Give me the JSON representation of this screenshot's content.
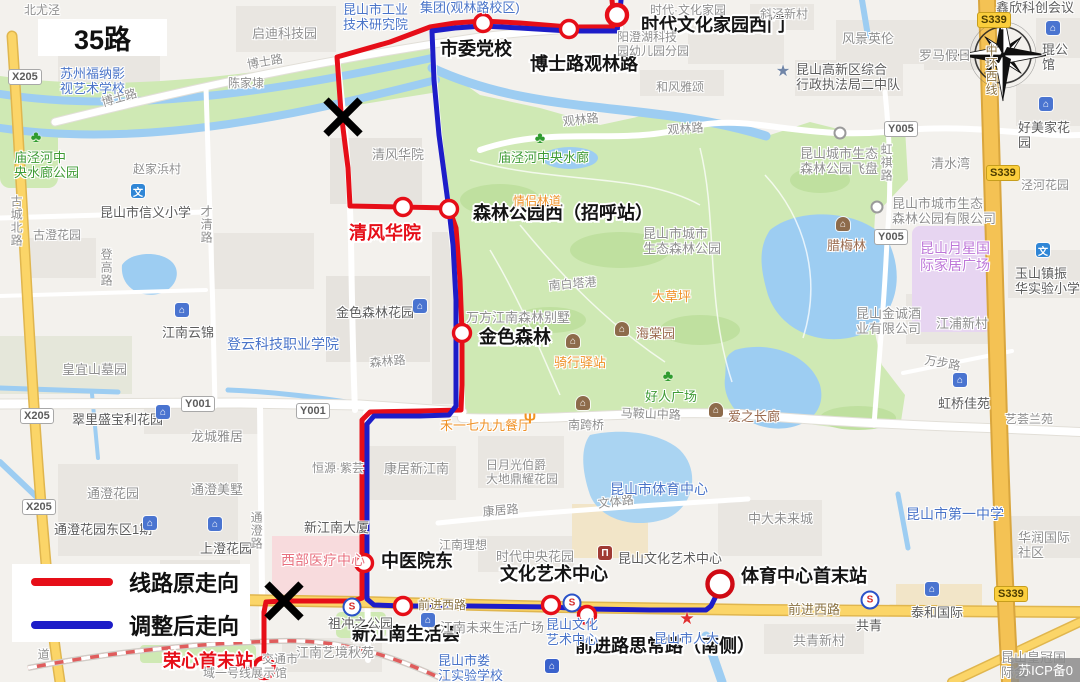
{
  "title": "35路",
  "legend": {
    "original_label": "线路原走向",
    "adjusted_label": "调整后走向",
    "original_color": "#e60e18",
    "adjusted_color": "#1d1dc8"
  },
  "watermark": "苏ICP备0",
  "routes": {
    "original": {
      "name": "线路原走向",
      "color": "#e60e18",
      "points": [
        [
          612,
          0
        ],
        [
          613,
          10
        ],
        [
          615,
          20
        ],
        [
          614,
          27
        ],
        [
          569,
          27
        ],
        [
          520,
          23
        ],
        [
          483,
          21
        ],
        [
          455,
          23
        ],
        [
          430,
          27
        ],
        [
          390,
          42
        ],
        [
          337,
          57
        ],
        [
          341,
          112
        ],
        [
          348,
          168
        ],
        [
          350,
          206
        ],
        [
          403,
          207
        ],
        [
          449,
          208
        ],
        [
          456,
          228
        ],
        [
          460,
          280
        ],
        [
          462,
          333
        ],
        [
          462,
          385
        ],
        [
          461,
          410
        ],
        [
          420,
          411
        ],
        [
          370,
          412
        ],
        [
          362,
          420
        ],
        [
          362,
          480
        ],
        [
          362,
          563
        ],
        [
          362,
          598
        ],
        [
          354,
          601
        ],
        [
          283,
          601
        ],
        [
          266,
          602
        ],
        [
          264,
          612
        ],
        [
          264,
          668
        ]
      ]
    },
    "adjusted": {
      "name": "调整后走向",
      "color": "#1d1dc8",
      "points": [
        [
          621,
          0
        ],
        [
          620,
          12
        ],
        [
          618,
          24
        ],
        [
          617,
          31
        ],
        [
          569,
          31
        ],
        [
          520,
          28
        ],
        [
          483,
          26
        ],
        [
          455,
          28
        ],
        [
          432,
          31
        ],
        [
          434,
          80
        ],
        [
          439,
          135
        ],
        [
          445,
          180
        ],
        [
          449,
          210
        ],
        [
          453,
          245
        ],
        [
          456,
          300
        ],
        [
          456,
          360
        ],
        [
          456,
          406
        ],
        [
          449,
          415
        ],
        [
          420,
          416
        ],
        [
          374,
          416
        ],
        [
          367,
          424
        ],
        [
          367,
          480
        ],
        [
          367,
          563
        ],
        [
          367,
          599
        ],
        [
          374,
          605
        ],
        [
          403,
          606
        ],
        [
          470,
          606
        ],
        [
          551,
          607
        ],
        [
          587,
          609
        ],
        [
          650,
          610
        ],
        [
          706,
          610
        ],
        [
          711,
          606
        ],
        [
          716,
          596
        ],
        [
          720,
          588
        ]
      ]
    }
  },
  "stations": [
    {
      "name": "市委党校",
      "x": 483,
      "y": 23,
      "lx": 440,
      "ly": 40,
      "color": "black"
    },
    {
      "name": "博士路观林路",
      "x": 569,
      "y": 29,
      "lx": 530,
      "ly": 55,
      "color": "black"
    },
    {
      "name": "时代文化家园西门",
      "x": 617,
      "y": 15,
      "lx": 641,
      "ly": 16,
      "color": "black",
      "big": true
    },
    {
      "name": "森林公园西（招呼站）",
      "x": 449,
      "y": 209,
      "lx": 473,
      "ly": 204,
      "color": "black"
    },
    {
      "name": "清风华院",
      "x": 403,
      "y": 207,
      "lx": 349,
      "ly": 224,
      "color": "red"
    },
    {
      "name": "金色森林",
      "x": 462,
      "y": 333,
      "lx": 479,
      "ly": 328,
      "color": "black"
    },
    {
      "name": "中医院东",
      "x": 364,
      "y": 563,
      "lx": 381,
      "ly": 552,
      "color": "black"
    },
    {
      "name": "新江南生活荟",
      "x": 403,
      "y": 606,
      "lx": 352,
      "ly": 625,
      "color": "black"
    },
    {
      "name": "文化艺术中心",
      "x": 551,
      "y": 605,
      "lx": 500,
      "ly": 565,
      "color": "black"
    },
    {
      "name": "前进路思常路（南侧）",
      "x": 587,
      "y": 615,
      "lx": 575,
      "ly": 637,
      "color": "black"
    },
    {
      "name": "体育中心首末站",
      "x": 720,
      "y": 584,
      "lx": 741,
      "ly": 567,
      "color": "black",
      "big": true,
      "r": 12.5,
      "ring": "#cf0a14"
    },
    {
      "name": "荣心首末站",
      "x": 264,
      "y": 668,
      "lx": 163,
      "ly": 652,
      "color": "red",
      "big": true
    }
  ],
  "x_marks": [
    [
      343,
      117
    ],
    [
      284,
      601
    ]
  ],
  "road_badges": [
    {
      "t": "X205",
      "x": 8,
      "y": 69
    },
    {
      "t": "X205",
      "x": 20,
      "y": 408
    },
    {
      "t": "X205",
      "x": 22,
      "y": 499
    },
    {
      "t": "Y001",
      "x": 181,
      "y": 396
    },
    {
      "t": "Y001",
      "x": 296,
      "y": 403
    },
    {
      "t": "Y005",
      "x": 884,
      "y": 121
    },
    {
      "t": "Y005",
      "x": 874,
      "y": 229
    },
    {
      "t": "S339",
      "x": 977,
      "y": 12,
      "prov": true
    },
    {
      "t": "S339",
      "x": 986,
      "y": 165,
      "prov": true
    },
    {
      "t": "S339",
      "x": 994,
      "y": 586,
      "prov": true
    }
  ],
  "map_labels": [
    {
      "t": "北尤泾",
      "x": 24,
      "y": 3,
      "c": "gray",
      "s": 12
    },
    {
      "t": "启迪科技园",
      "x": 252,
      "y": 26,
      "c": "gray",
      "s": 13
    },
    {
      "t": "苏州福纳影\n视艺术学校",
      "x": 60,
      "y": 66,
      "c": "blue",
      "s": 13
    },
    {
      "t": "博士路",
      "x": 100,
      "y": 96,
      "c": "gray",
      "s": 12,
      "r": -16
    },
    {
      "t": "博士路",
      "x": 246,
      "y": 58,
      "c": "gray",
      "s": 12,
      "r": -10
    },
    {
      "t": "陈家埭",
      "x": 228,
      "y": 76,
      "c": "gray",
      "s": 12
    },
    {
      "t": "庙泾河中\n央水廊公园",
      "x": 14,
      "y": 150,
      "c": "green",
      "s": 13
    },
    {
      "t": "赵家浜村",
      "x": 133,
      "y": 162,
      "c": "gray",
      "s": 12
    },
    {
      "t": "昆山市信义小学",
      "x": 100,
      "y": 205,
      "c": "dark",
      "s": 13
    },
    {
      "t": "古城北路",
      "x": 9,
      "y": 195,
      "c": "gray",
      "s": 12,
      "v": 1
    },
    {
      "t": "才清路",
      "x": 199,
      "y": 205,
      "c": "gray",
      "s": 12,
      "v": 1
    },
    {
      "t": "古澄花园",
      "x": 33,
      "y": 228,
      "c": "gray",
      "s": 12
    },
    {
      "t": "登高路",
      "x": 99,
      "y": 248,
      "c": "gray",
      "s": 12,
      "v": 1
    },
    {
      "t": "庙泾河中央水廊",
      "x": 498,
      "y": 150,
      "c": "green",
      "s": 13
    },
    {
      "t": "清风华院",
      "x": 372,
      "y": 147,
      "c": "gray",
      "s": 13
    },
    {
      "t": "昆山市工业\n技术研究院",
      "x": 343,
      "y": 2,
      "c": "blue",
      "s": 13
    },
    {
      "t": "集团(观林路校区)",
      "x": 420,
      "y": 0,
      "c": "blue",
      "s": 13
    },
    {
      "t": "时代·文化家园",
      "x": 650,
      "y": 3,
      "c": "gray",
      "s": 12
    },
    {
      "t": "阳澄湖科技\n园幼儿园分园",
      "x": 617,
      "y": 30,
      "c": "gray",
      "s": 12
    },
    {
      "t": "和风雅颂",
      "x": 656,
      "y": 80,
      "c": "gray",
      "s": 12
    },
    {
      "t": "观林路",
      "x": 562,
      "y": 115,
      "c": "gray",
      "s": 12,
      "r": -7
    },
    {
      "t": "观林路",
      "x": 667,
      "y": 123,
      "c": "gray",
      "s": 12,
      "r": -4
    },
    {
      "t": "斜泾新村",
      "x": 760,
      "y": 7,
      "c": "gray",
      "s": 12
    },
    {
      "t": "风景英伦",
      "x": 842,
      "y": 31,
      "c": "gray",
      "s": 13
    },
    {
      "t": "罗马假日",
      "x": 919,
      "y": 48,
      "c": "gray",
      "s": 13
    },
    {
      "t": "鑫欣科创会议中",
      "x": 996,
      "y": 0,
      "c": "dark",
      "s": 13
    },
    {
      "t": "琨公馆",
      "x": 1042,
      "y": 42,
      "c": "dark",
      "s": 13
    },
    {
      "t": "好美家花园",
      "x": 1018,
      "y": 120,
      "c": "dark",
      "s": 13
    },
    {
      "t": "中环西线",
      "x": 984,
      "y": 44,
      "c": "road",
      "s": 12,
      "v": 1
    },
    {
      "t": "昆山高新区综合\n行政执法局二中队",
      "x": 796,
      "y": 62,
      "c": "dark",
      "s": 13
    },
    {
      "t": "昆山城市生态\n森林公园飞盘",
      "x": 800,
      "y": 146,
      "c": "gray",
      "s": 13
    },
    {
      "t": "虹祺路",
      "x": 879,
      "y": 143,
      "c": "gray",
      "s": 12,
      "v": 1
    },
    {
      "t": "清水湾",
      "x": 931,
      "y": 156,
      "c": "gray",
      "s": 13
    },
    {
      "t": "昆山市城市生态\n森林公园有限公司",
      "x": 892,
      "y": 196,
      "c": "gray",
      "s": 13
    },
    {
      "t": "泾河花园",
      "x": 1021,
      "y": 178,
      "c": "gray",
      "s": 12
    },
    {
      "t": "玉山镇振\n华实验小学",
      "x": 1015,
      "y": 266,
      "c": "dark",
      "s": 13
    },
    {
      "t": "昆山月星国\n际家居广场",
      "x": 920,
      "y": 240,
      "c": "purple",
      "s": 14
    },
    {
      "t": "腊梅林",
      "x": 827,
      "y": 238,
      "c": "brown",
      "s": 13
    },
    {
      "t": "昆山金诚酒\n业有限公司",
      "x": 856,
      "y": 306,
      "c": "gray",
      "s": 13
    },
    {
      "t": "江浦新村",
      "x": 936,
      "y": 316,
      "c": "gray",
      "s": 13
    },
    {
      "t": "万步路",
      "x": 926,
      "y": 353,
      "c": "gray",
      "s": 12,
      "r": 10
    },
    {
      "t": "虹桥佳苑",
      "x": 938,
      "y": 396,
      "c": "dark",
      "s": 13
    },
    {
      "t": "艺荟兰苑",
      "x": 1005,
      "y": 412,
      "c": "gray",
      "s": 12
    },
    {
      "t": "昆山市城市\n生态森林公园",
      "x": 643,
      "y": 226,
      "c": "gray",
      "s": 13
    },
    {
      "t": "大草坪",
      "x": 652,
      "y": 289,
      "c": "orange",
      "s": 13
    },
    {
      "t": "海棠园",
      "x": 636,
      "y": 326,
      "c": "brown",
      "s": 13
    },
    {
      "t": "骑行驿站",
      "x": 554,
      "y": 355,
      "c": "orange",
      "s": 13
    },
    {
      "t": "好人广场",
      "x": 645,
      "y": 389,
      "c": "green",
      "s": 13
    },
    {
      "t": "南白塔港",
      "x": 548,
      "y": 279,
      "c": "gray",
      "s": 12,
      "r": -5
    },
    {
      "t": "万方江南森林别墅",
      "x": 466,
      "y": 310,
      "c": "gray",
      "s": 13
    },
    {
      "t": "金色森林花园",
      "x": 336,
      "y": 305,
      "c": "dark",
      "s": 13
    },
    {
      "t": "森林路",
      "x": 369,
      "y": 356,
      "c": "gray",
      "s": 12,
      "r": -5
    },
    {
      "t": "爱之长廊",
      "x": 728,
      "y": 409,
      "c": "brown",
      "s": 13
    },
    {
      "t": "马鞍山中路",
      "x": 621,
      "y": 406,
      "c": "gray",
      "s": 12,
      "r": 2
    },
    {
      "t": "南跨桥",
      "x": 568,
      "y": 418,
      "c": "gray",
      "s": 12
    },
    {
      "t": "禾一七九九餐厅",
      "x": 440,
      "y": 418,
      "c": "orange",
      "s": 13
    },
    {
      "t": "情侣林道",
      "x": 513,
      "y": 194,
      "c": "orange",
      "s": 12
    },
    {
      "t": "江南云锦",
      "x": 162,
      "y": 325,
      "c": "dark",
      "s": 13
    },
    {
      "t": "登云科技职业学院",
      "x": 227,
      "y": 336,
      "c": "blue",
      "s": 14
    },
    {
      "t": "皇宜山墓园",
      "x": 62,
      "y": 362,
      "c": "gray",
      "s": 13
    },
    {
      "t": "翠里盛宝利花园",
      "x": 72,
      "y": 412,
      "c": "dark",
      "s": 13
    },
    {
      "t": "龙城雅居",
      "x": 191,
      "y": 429,
      "c": "gray",
      "s": 13
    },
    {
      "t": "通澄花园",
      "x": 87,
      "y": 486,
      "c": "gray",
      "s": 13
    },
    {
      "t": "通澄美墅",
      "x": 191,
      "y": 482,
      "c": "gray",
      "s": 13
    },
    {
      "t": "通澄花园东区1期",
      "x": 54,
      "y": 522,
      "c": "dark",
      "s": 13
    },
    {
      "t": "上澄花园",
      "x": 200,
      "y": 541,
      "c": "dark",
      "s": 13
    },
    {
      "t": "通澄路",
      "x": 249,
      "y": 511,
      "c": "gray",
      "s": 12,
      "v": 1
    },
    {
      "t": "新江南大厦",
      "x": 304,
      "y": 520,
      "c": "dark",
      "s": 13
    },
    {
      "t": "恒源·紫芸",
      "x": 312,
      "y": 461,
      "c": "gray",
      "s": 12
    },
    {
      "t": "西部医疗中心",
      "x": 281,
      "y": 552,
      "c": "pink",
      "s": 14
    },
    {
      "t": "康居新江南",
      "x": 384,
      "y": 461,
      "c": "gray",
      "s": 13
    },
    {
      "t": "日月光伯爵\n大地鼎耀花园",
      "x": 486,
      "y": 458,
      "c": "gray",
      "s": 12
    },
    {
      "t": "康居路",
      "x": 482,
      "y": 505,
      "c": "gray",
      "s": 12,
      "r": -5
    },
    {
      "t": "江南理想",
      "x": 439,
      "y": 538,
      "c": "gray",
      "s": 12
    },
    {
      "t": "时代中央花园",
      "x": 496,
      "y": 549,
      "c": "gray",
      "s": 13
    },
    {
      "t": "文体路",
      "x": 597,
      "y": 497,
      "c": "gray",
      "s": 12,
      "r": -7
    },
    {
      "t": "昆山市体育中心",
      "x": 610,
      "y": 481,
      "c": "blue",
      "s": 14
    },
    {
      "t": "昆山文化艺术中心",
      "x": 618,
      "y": 551,
      "c": "dark",
      "s": 13
    },
    {
      "t": "中大未来城",
      "x": 748,
      "y": 511,
      "c": "gray",
      "s": 13
    },
    {
      "t": "昆山市第一中学",
      "x": 906,
      "y": 506,
      "c": "blue",
      "s": 14
    },
    {
      "t": "华润国际社区",
      "x": 1018,
      "y": 530,
      "c": "gray",
      "s": 13
    },
    {
      "t": "前进西路",
      "x": 418,
      "y": 598,
      "c": "road",
      "s": 12
    },
    {
      "t": "前进西路",
      "x": 788,
      "y": 602,
      "c": "road",
      "s": 13
    },
    {
      "t": "祖冲之公园",
      "x": 328,
      "y": 616,
      "c": "dark",
      "s": 13
    },
    {
      "t": "江南未来生活广场",
      "x": 440,
      "y": 620,
      "c": "gray",
      "s": 13
    },
    {
      "t": "昆山文化\n艺术中心",
      "x": 546,
      "y": 617,
      "c": "blue",
      "s": 13
    },
    {
      "t": "昆山市人大",
      "x": 654,
      "y": 631,
      "c": "blue",
      "s": 13
    },
    {
      "t": "江南艺境秋苑",
      "x": 296,
      "y": 645,
      "c": "gray",
      "s": 13
    },
    {
      "t": "昆山市娄\n江实验学校",
      "x": 438,
      "y": 653,
      "c": "blue",
      "s": 13
    },
    {
      "t": "交通市",
      "x": 262,
      "y": 652,
      "c": "gray",
      "s": 12
    },
    {
      "t": "域一号线展示馆",
      "x": 203,
      "y": 666,
      "c": "gray",
      "s": 12
    },
    {
      "t": "道",
      "x": 36,
      "y": 648,
      "c": "gray",
      "s": 12,
      "v": 1
    },
    {
      "t": "共青",
      "x": 856,
      "y": 618,
      "c": "dark",
      "s": 13
    },
    {
      "t": "共青新村",
      "x": 793,
      "y": 633,
      "c": "gray",
      "s": 13
    },
    {
      "t": "泰和国际",
      "x": 911,
      "y": 605,
      "c": "dark",
      "s": 13
    },
    {
      "t": "昆山皇冠国\n际会",
      "x": 1001,
      "y": 650,
      "c": "gray",
      "s": 13
    }
  ],
  "map_icons": [
    {
      "k": "tree",
      "x": 36,
      "y": 138
    },
    {
      "k": "tree",
      "x": 540,
      "y": 139
    },
    {
      "k": "tree",
      "x": 668,
      "y": 377
    },
    {
      "k": "school",
      "x": 138,
      "y": 191,
      "g": "文"
    },
    {
      "k": "school",
      "x": 1043,
      "y": 250,
      "g": "文"
    },
    {
      "k": "building",
      "x": 1053,
      "y": 28
    },
    {
      "k": "building",
      "x": 1046,
      "y": 104
    },
    {
      "k": "building",
      "x": 182,
      "y": 310
    },
    {
      "k": "building",
      "x": 420,
      "y": 306
    },
    {
      "k": "building",
      "x": 163,
      "y": 412
    },
    {
      "k": "building",
      "x": 150,
      "y": 523
    },
    {
      "k": "building",
      "x": 215,
      "y": 524
    },
    {
      "k": "building",
      "x": 960,
      "y": 380
    },
    {
      "k": "building",
      "x": 932,
      "y": 589
    },
    {
      "k": "building",
      "x": 428,
      "y": 620
    },
    {
      "k": "pavilion",
      "x": 843,
      "y": 224
    },
    {
      "k": "pavilion",
      "x": 622,
      "y": 329
    },
    {
      "k": "pavilion",
      "x": 573,
      "y": 341
    },
    {
      "k": "pavilion",
      "x": 716,
      "y": 410
    },
    {
      "k": "pavilion",
      "x": 583,
      "y": 403
    },
    {
      "k": "museum",
      "x": 605,
      "y": 553
    },
    {
      "k": "house",
      "x": 552,
      "y": 666
    },
    {
      "k": "star-blue",
      "x": 783,
      "y": 71
    },
    {
      "k": "star-red",
      "x": 687,
      "y": 619
    },
    {
      "k": "circle",
      "x": 840,
      "y": 133
    },
    {
      "k": "circle",
      "x": 877,
      "y": 207
    },
    {
      "k": "metro",
      "x": 352,
      "y": 607
    },
    {
      "k": "metro",
      "x": 572,
      "y": 603
    },
    {
      "k": "metro",
      "x": 870,
      "y": 600
    },
    {
      "k": "fork",
      "x": 530,
      "y": 419
    }
  ]
}
